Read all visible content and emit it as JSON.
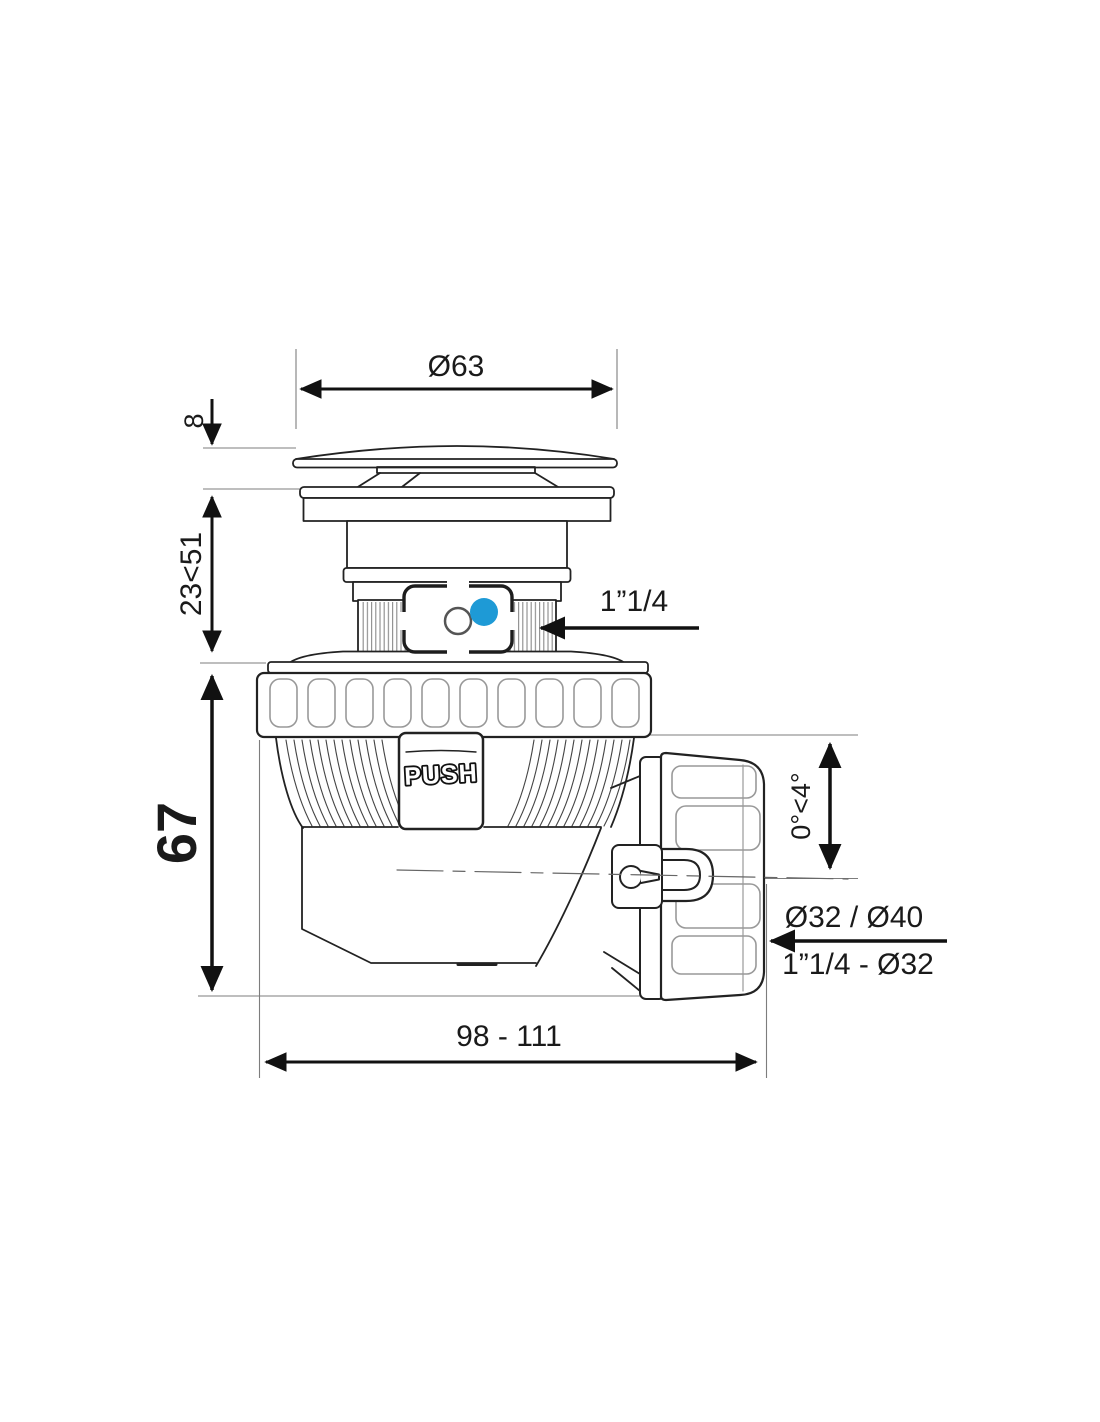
{
  "drawing": {
    "dimensions": {
      "cap_diameter": "Ø63",
      "cap_height": "8",
      "adjustment_range": "23<51",
      "body_height": "67",
      "inlet_thread": "1”1/4",
      "outlet_angle": "0°<4°",
      "outlet_diameters": "Ø32 / Ø40",
      "outlet_adapter": "1”1/4 - Ø32",
      "overall_length": "98 - 111"
    },
    "labels": {
      "push_button": "PUSH"
    },
    "colors": {
      "accent_blue": "#1E9AD6",
      "line_dark": "#222222",
      "dimension_black": "#111111",
      "extension_gray": "#7d7d7d"
    }
  }
}
